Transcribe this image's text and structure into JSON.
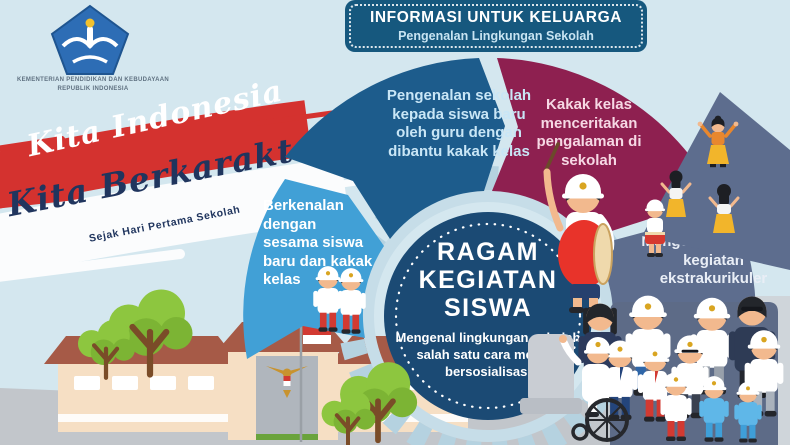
{
  "header": {
    "title": "INFORMASI UNTUK KELUARGA",
    "subtitle": "Pengenalan Lingkungan Sekolah"
  },
  "logo": {
    "name": "tut-wuri-handayani-logo",
    "ministry_line1": "KEMENTERIAN PENDIDIKAN DAN KEBUDAYAAN",
    "ministry_line2": "REPUBLIK INDONESIA"
  },
  "campaign": {
    "line1": "Kita Indonesia",
    "line2": "Kita Berkarakter",
    "tagline": "Sejak Hari Pertama Sekolah"
  },
  "diagram": {
    "center_title": "RAGAM KEGIATAN SISWA",
    "center_description": "Mengenal lingkungan sekolah salah satu cara melatih bersosialisasi",
    "segments": [
      {
        "id": "berkenalan",
        "label": "Berkenalan dengan sesama siswa baru dan kakak kelas",
        "color": "#41a0d6",
        "text_color": "#ffffff"
      },
      {
        "id": "pengenalan-sekolah",
        "label": "Pengenalan sekolah kepada siswa baru oleh guru dengan dibantu kakak kelas",
        "color": "#1d5c8c",
        "text_color": "#c9e6f6"
      },
      {
        "id": "kakak-kelas",
        "label": "Kakak kelas menceritakan pengalaman di sekolah",
        "color": "#8e2050",
        "text_color": "#f6d8e4"
      },
      {
        "id": "ekstrakurikuler",
        "label": "Mengenalkan ragam kegiatan ekstrakurikuler",
        "color": "#5d6d8e",
        "text_color": "#e9eef6"
      }
    ]
  },
  "illustrations": {
    "school_building": "school-building-with-flag",
    "flag": "indonesian-flag",
    "emblem": "garuda-pancasila-emblem",
    "students": "students-group",
    "wheelchair_student": "student-in-wheelchair",
    "drummer": "drummer-boy",
    "dancers": "traditional-dancers",
    "trees": "green-trees"
  },
  "colors": {
    "background": "#d4e7ef",
    "banner": "#16587e",
    "center_circle": "#1b4a74",
    "brush_red": "#d4322f",
    "brush_white": "#fbfcfd",
    "ground": "#c2c6cb",
    "roof": "#a65a47",
    "wall": "#f6dfc4",
    "backdrop": "#5d6b87"
  }
}
